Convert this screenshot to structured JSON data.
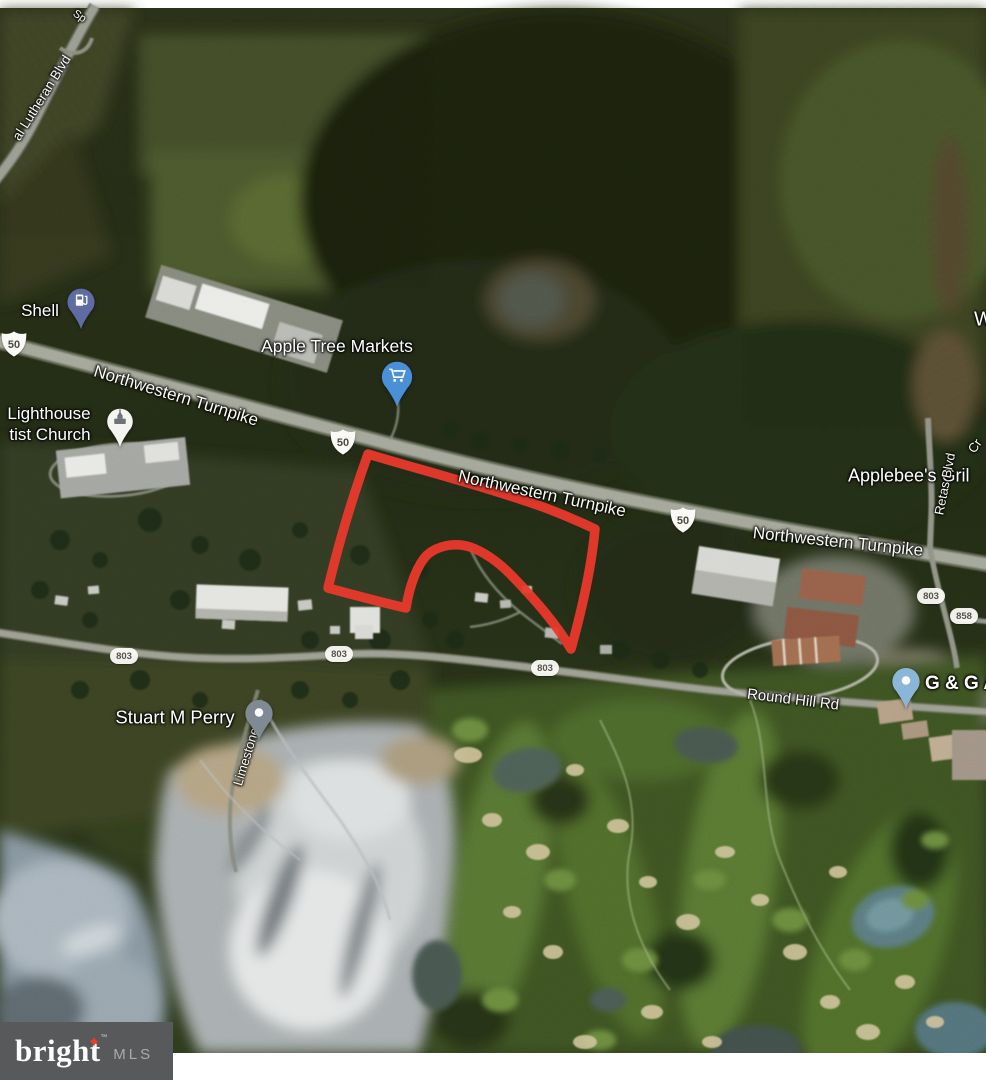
{
  "logo": {
    "brand": "bright",
    "tm": "™",
    "suffix": "MLS"
  },
  "labels": {
    "sp_fragment": "Sp",
    "lutheran": "al Lutheran Blvd",
    "shell": "Shell",
    "turnpike1": "Northwestern Turnpike",
    "apple_tree": "Apple Tree Markets",
    "lighthouse_line1": "Lighthouse",
    "lighthouse_line2": "tist Church",
    "turnpike2": "Northwestern Turnpike",
    "turnpike3": "Northwestern Turnpike",
    "applebees": "Applebee's Gril",
    "retas": "Retas Blvd",
    "cr_fragment": "Cr",
    "w_fragment": "W",
    "round_hill": "Round Hill Rd",
    "stuart": "Stuart M Perry",
    "limestone": "Limestone Ln",
    "gg": "G & G A"
  },
  "shields": {
    "us50": "50",
    "r803": "803",
    "r858": "858"
  },
  "colors": {
    "parcel_outline": "#e9392c",
    "logo_box": "#58595b",
    "logo_star": "#ef4023",
    "logo_text": "#fdfdfd",
    "logo_mls": "#a9abae",
    "shell_pin": "#5f6ba3",
    "cart_pin": "#4a90d9",
    "church_pin": "#f4f4f1",
    "stuart_pin": "#7f8a95",
    "gg_pin": "#8cb6d8"
  }
}
